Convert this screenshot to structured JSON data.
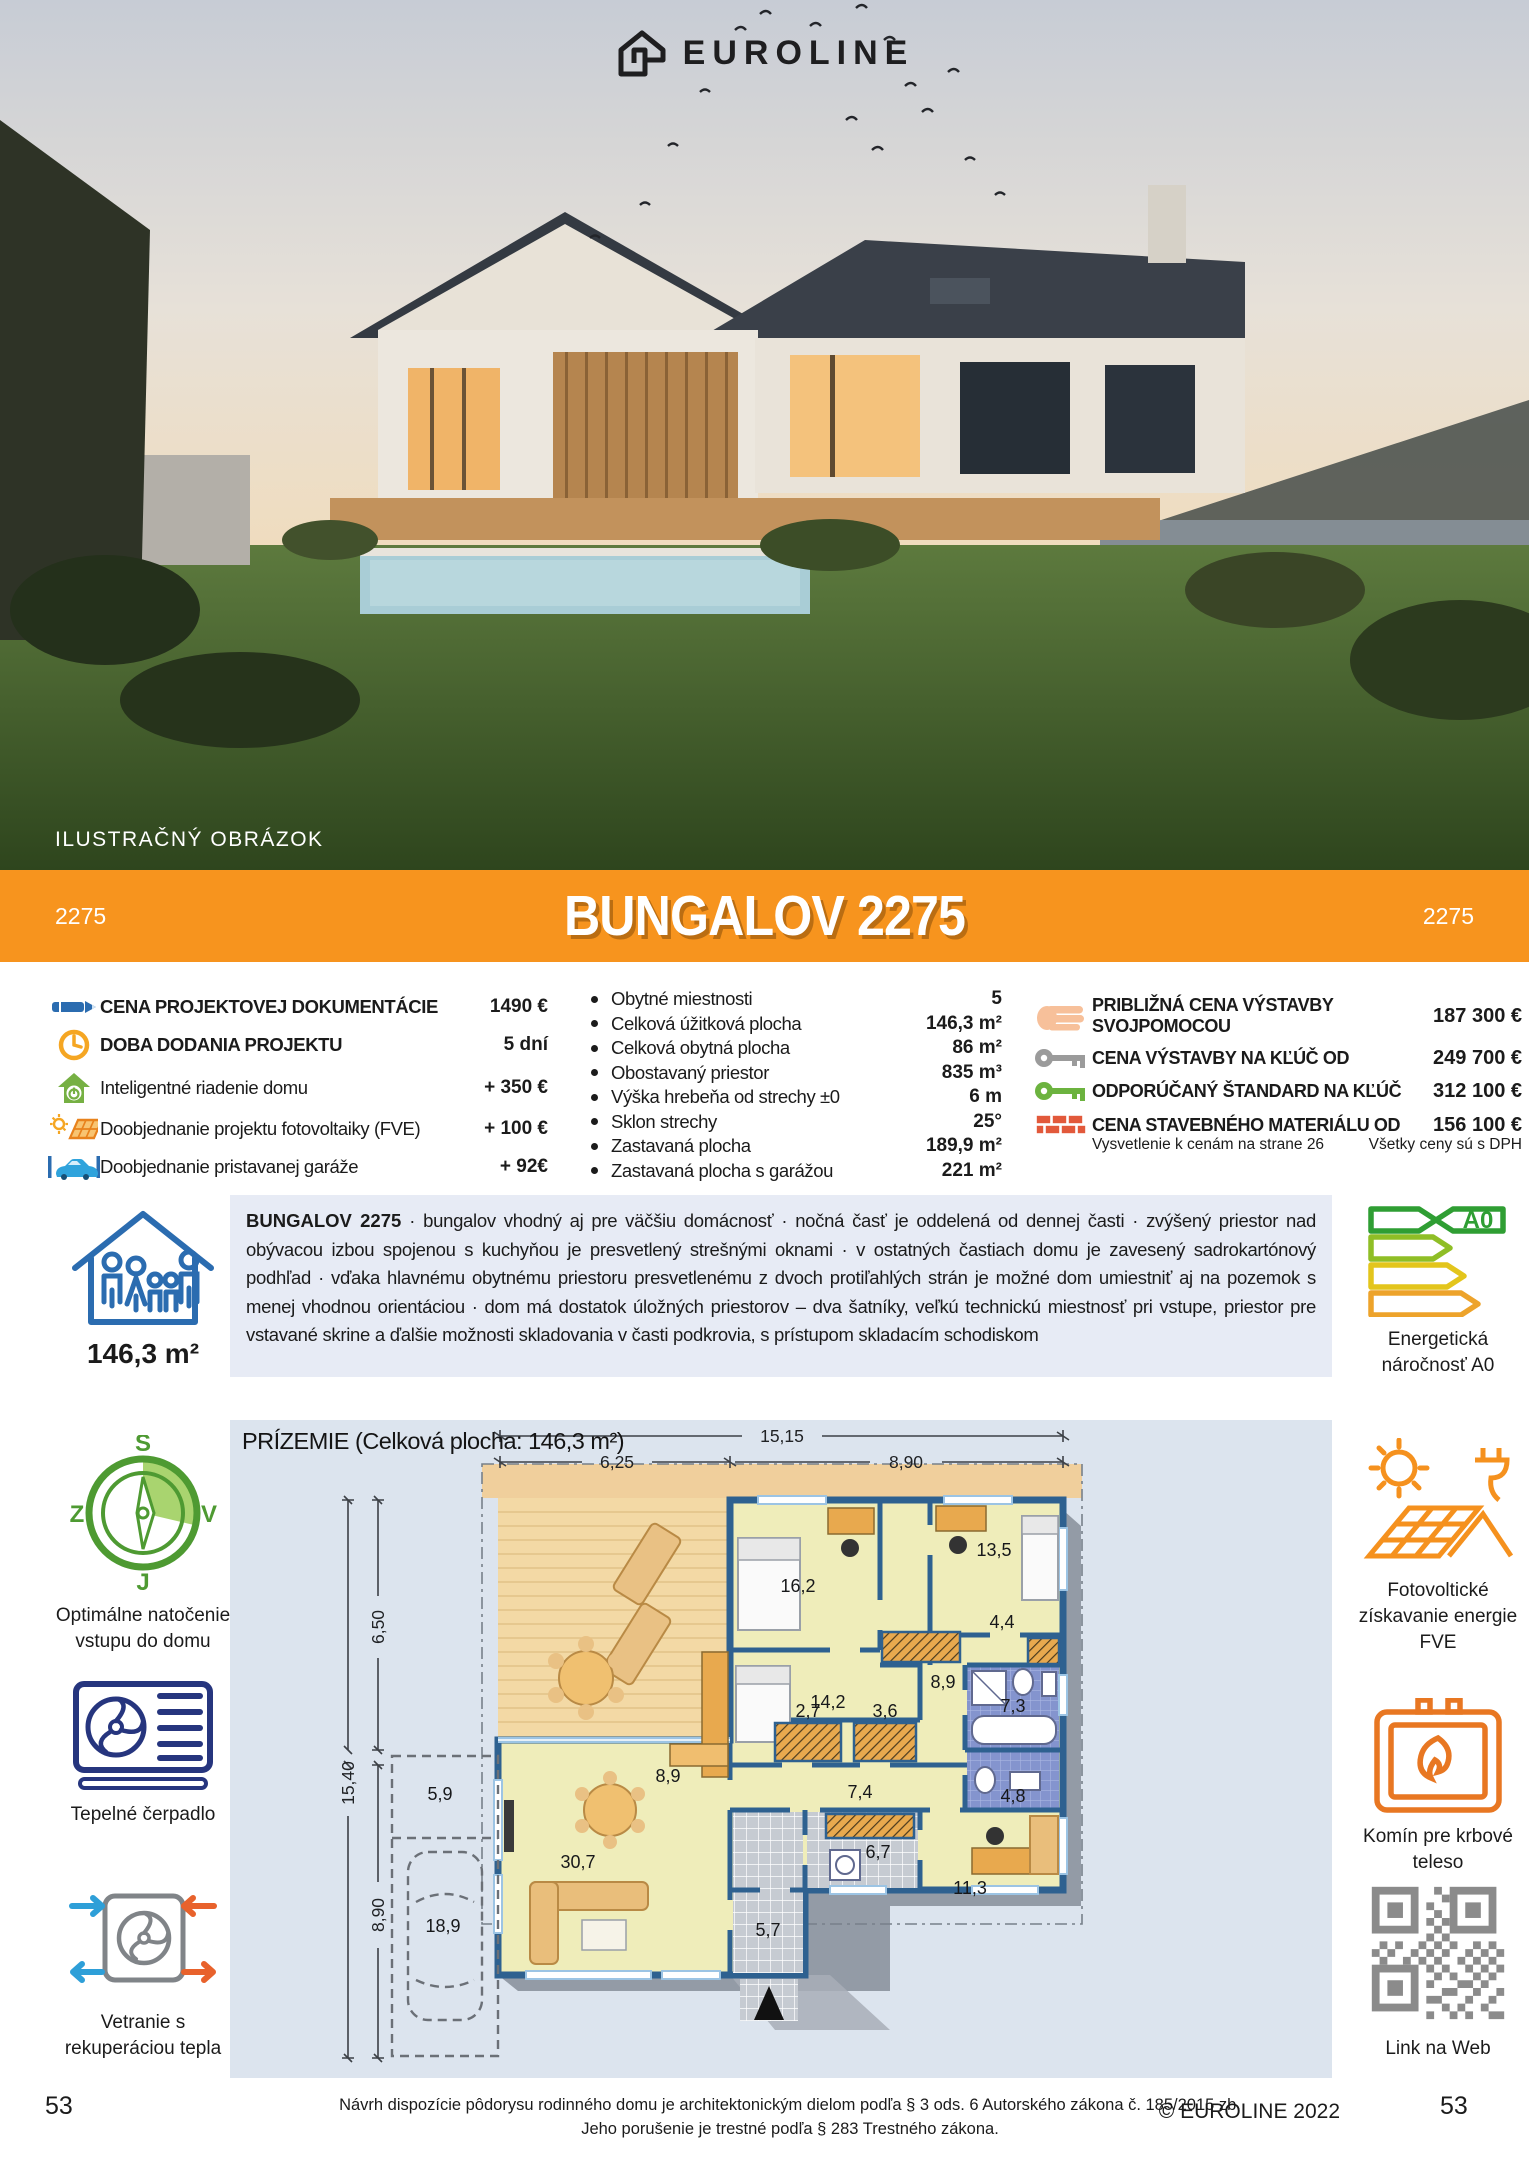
{
  "logo": {
    "text": "EUROLINE"
  },
  "photo_caption": "ILUSTRAČNÝ OBRÁZOK",
  "banner": {
    "left_code": "2275",
    "title": "BUNGALOV 2275",
    "right_code": "2275",
    "color": "#F7941E"
  },
  "pricing_left": {
    "rows": [
      {
        "icon": "pencil",
        "label": "CENA PROJEKTOVEJ DOKUMENTÁCIE",
        "value": "1490 €"
      },
      {
        "icon": "clock",
        "label": "DOBA DODANIA PROJEKTU",
        "value": "5 dní"
      },
      {
        "icon": "smart-home",
        "label": "Inteligentné riadenie domu",
        "value": "+ 350 €"
      },
      {
        "icon": "solar",
        "label": "Doobjednanie projektu fotovoltaiky (FVE)",
        "value": "+ 100 €"
      },
      {
        "icon": "garage-car",
        "label": "Doobjednanie pristavanej garáže",
        "value": "+ 92€"
      }
    ]
  },
  "specs": {
    "rows": [
      {
        "label": "Obytné miestnosti",
        "value": "5"
      },
      {
        "label": "Celková úžitková plocha",
        "value": "146,3 m²"
      },
      {
        "label": "Celková obytná plocha",
        "value": "86 m²"
      },
      {
        "label": "Obostavaný priestor",
        "value": "835 m³"
      },
      {
        "label": "Výška hrebeňa od strechy ±0",
        "value": "6 m"
      },
      {
        "label": "Sklon strechy",
        "value": "25°"
      },
      {
        "label": "Zastavaná plocha",
        "value": "189,9 m²"
      },
      {
        "label": "Zastavaná plocha s garážou",
        "value": "221 m²"
      }
    ]
  },
  "pricing_right": {
    "rows": [
      {
        "icon": "hand",
        "label": "PRIBLIŽNÁ CENA VÝSTAVBY SVOJPOMOCOU",
        "value": "187 300 €"
      },
      {
        "icon": "key-gray",
        "label": "CENA VÝSTAVBY NA KĽÚČ OD",
        "value": "249 700 €"
      },
      {
        "icon": "key-green",
        "label": "ODPORÚČANÝ ŠTANDARD NA KĽÚČ",
        "value": "312 100 €"
      },
      {
        "icon": "bricks",
        "label": "CENA STAVEBNÉHO MATERIÁLU OD",
        "value": "156 100 €"
      }
    ],
    "note_left": "Vysvetlenie k cenám na strane 26",
    "note_right": "Všetky ceny sú s DPH"
  },
  "description": {
    "lead": "BUNGALOV 2275",
    "text": " · bungalov vhodný aj pre väčšiu domácnosť · nočná časť je oddelená od dennej časti · zvýšený priestor nad obývacou izbou spojenou s kuchyňou je presvetlený strešnými oknami · v ostatných častiach domu je zavesený sadrokartónový podhľad · vďaka hlavnému obytnému priestoru presvetlenému z dvoch protiľahlých strán je možné dom umiestniť aj na pozemok s menej vhodnou orientáciou · dom má dostatok úložných priestorov – dva šatníky, veľkú technickú miestnosť pri vstupe, priestor pre vstavané skrine a ďalšie možnosti skladovania v časti podkrovia, s prístupom skladacím schodiskom"
  },
  "sidebar_left": {
    "area": "146,3 m²",
    "compass": {
      "n": "S",
      "e": "V",
      "s": "J",
      "w": "Z",
      "caption": "Optimálne natočenie vstupu do domu"
    },
    "heat_pump_caption": "Tepelné čerpadlo",
    "ventilation_caption": "Vetranie s rekuperáciou tepla"
  },
  "sidebar_right": {
    "energy_badge": "A0",
    "energy_caption": "Energetická náročnosť A0",
    "pv_caption": "Fotovoltické získavanie energie FVE",
    "chimney_caption": "Komín pre krbové teleso",
    "qr_caption": "Link na Web"
  },
  "floorplan": {
    "title": "PRÍZEMIE (Celková plocha: 146,3 m²)",
    "dims": {
      "top_total": "15,15",
      "top_left": "6,25",
      "top_right": "8,90",
      "left_total": "15,40",
      "left_upper": "6,50",
      "left_lower": "8,90"
    },
    "rooms": {
      "living": "30,7",
      "dining": "8,9",
      "bedroom1": "16,2",
      "bedroom2": "13,5",
      "bedroom3": "14,2",
      "corridor": "8,9",
      "wardrobe1": "2,7",
      "wardrobe2": "3,6",
      "hall": "7,4",
      "bath1": "7,3",
      "bath2": "4,8",
      "storage": "4,4",
      "entry": "5,7",
      "tech": "6,7",
      "office": "11,3",
      "garage": "18,9",
      "garage_front": "5,9"
    }
  },
  "footer": {
    "legal_line1": "Návrh dispozície pôdorysu rodinného domu je architektonickým dielom podľa § 3 ods. 6 Autorského zákona č. 185/2015 zb.",
    "legal_line2": "Jeho porušenie je trestné podľa § 283 Trestného zákona.",
    "copyright": "© EUROLINE 2022",
    "page_left": "53",
    "page_right": "53"
  }
}
